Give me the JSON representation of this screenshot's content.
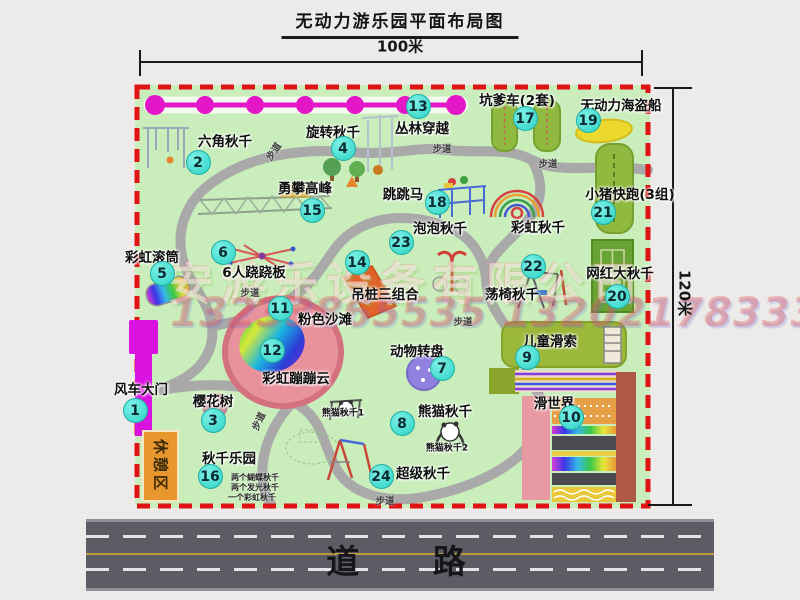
{
  "title": "无动力游乐园平面布局图",
  "dimensions": {
    "width": "100米",
    "height": "120米"
  },
  "road": {
    "label": "道 路"
  },
  "path_label": "步道",
  "watermark": {
    "company": "安游乐设备有限公司",
    "phones": "13233865535 13202178333"
  },
  "colors": {
    "park_green": "#c9edbb",
    "border_red": "#e01414",
    "badge_teal": "#2ed3c6",
    "chain_magenta": "#e316c8",
    "gate_magenta": "#d912e0",
    "road_gray": "#5c5c64"
  },
  "attractions": [
    {
      "num": "1",
      "name": "风车大门"
    },
    {
      "num": "2",
      "name": "六角秋千"
    },
    {
      "num": "3",
      "name": "樱花树"
    },
    {
      "num": "4",
      "name": "旋转秋千"
    },
    {
      "num": "5",
      "name": "彩虹滚筒"
    },
    {
      "num": "6",
      "name": "6人跷跷板"
    },
    {
      "num": "7",
      "name": "动物转盘"
    },
    {
      "num": "8",
      "name": "熊猫秋千"
    },
    {
      "num": "9",
      "name": "儿童滑索"
    },
    {
      "num": "10",
      "name": "滑世界"
    },
    {
      "num": "11",
      "name": "粉色沙滩"
    },
    {
      "num": "12",
      "name": "彩虹蹦蹦云"
    },
    {
      "num": "13",
      "name": "丛林穿越"
    },
    {
      "num": "14",
      "name": "吊桩三组合"
    },
    {
      "num": "15",
      "name": "勇攀高峰"
    },
    {
      "num": "16",
      "name": "秋千乐园"
    },
    {
      "num": "17",
      "name": "坑爹车(2套)"
    },
    {
      "num": "18",
      "name": "跳跳马"
    },
    {
      "num": "19",
      "name": "无动力海盗船"
    },
    {
      "num": "20",
      "name": "网红大秋千"
    },
    {
      "num": "21",
      "name": "小猪快跑(3组)"
    },
    {
      "num": "22",
      "name": "荡椅秋千"
    },
    {
      "num": "23",
      "name": "泡泡秋千"
    },
    {
      "num": "24",
      "name": "超级秋千"
    }
  ],
  "extras": {
    "rainbow_swing": "彩虹秋千",
    "rest_area": "休憩区",
    "panda_swing_1": "熊猫秋千1",
    "panda_swing_2": "熊猫秋千2",
    "notes": [
      "两个蝴蝶秋千",
      "两个发光秋千",
      "一个彩虹秋千"
    ]
  }
}
